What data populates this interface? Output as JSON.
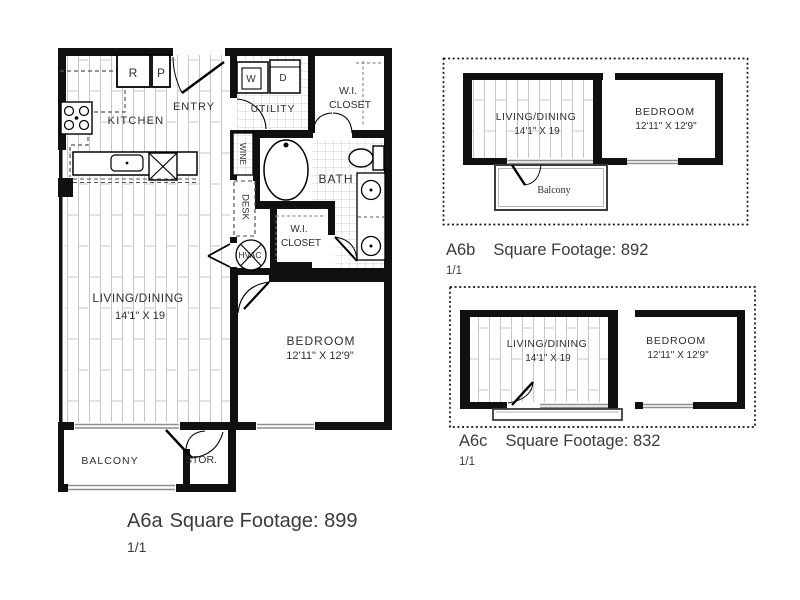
{
  "page": {
    "background": "#ffffff"
  },
  "colors": {
    "wall": "#101010",
    "floor_line": "#c7c7c7",
    "window_line": "#8f8f8f",
    "label_text": "#2e2e2e",
    "caption_text": "#3b3b3b"
  },
  "plans": {
    "a6a": {
      "caption_name": "A6a",
      "caption_footage": "Square Footage: 899",
      "page_indicator": "1/1",
      "labels": {
        "kitchen": "KITCHEN",
        "entry": "ENTRY",
        "utility": "UTILITY",
        "wi_closet_upper_l1": "W.I.",
        "wi_closet_upper_l2": "CLOSET",
        "wine": "WINE",
        "desk": "DESK",
        "bath": "BATH",
        "hvac": "HVAC",
        "wi_closet_hall_l1": "W.I.",
        "wi_closet_hall_l2": "CLOSET",
        "living_dining": "LIVING/DINING",
        "living_dining_dims": "14'1\" X 19",
        "bedroom": "BEDROOM",
        "bedroom_dims": "12'11\" X 12'9\"",
        "balcony": "BALCONY",
        "storage": "STOR.",
        "refrigerator": "R",
        "pantry": "P",
        "washer": "W",
        "dryer": "D"
      }
    },
    "a6b": {
      "caption_name": "A6b",
      "caption_footage": "Square Footage: 892",
      "page_indicator": "1/1",
      "labels": {
        "living_dining": "LIVING/DINING",
        "living_dining_dims": "14'1\" X 19",
        "bedroom": "BEDROOM",
        "bedroom_dims": "12'11\" X 12'9\"",
        "balcony": "Balcony"
      }
    },
    "a6c": {
      "caption_name": "A6c",
      "caption_footage": "Square Footage: 832",
      "page_indicator": "1/1",
      "labels": {
        "living_dining": "LIVING/DINING",
        "living_dining_dims": "14'1\" X 19",
        "bedroom": "BEDROOM",
        "bedroom_dims": "12'11\" X 12'9\""
      }
    }
  }
}
